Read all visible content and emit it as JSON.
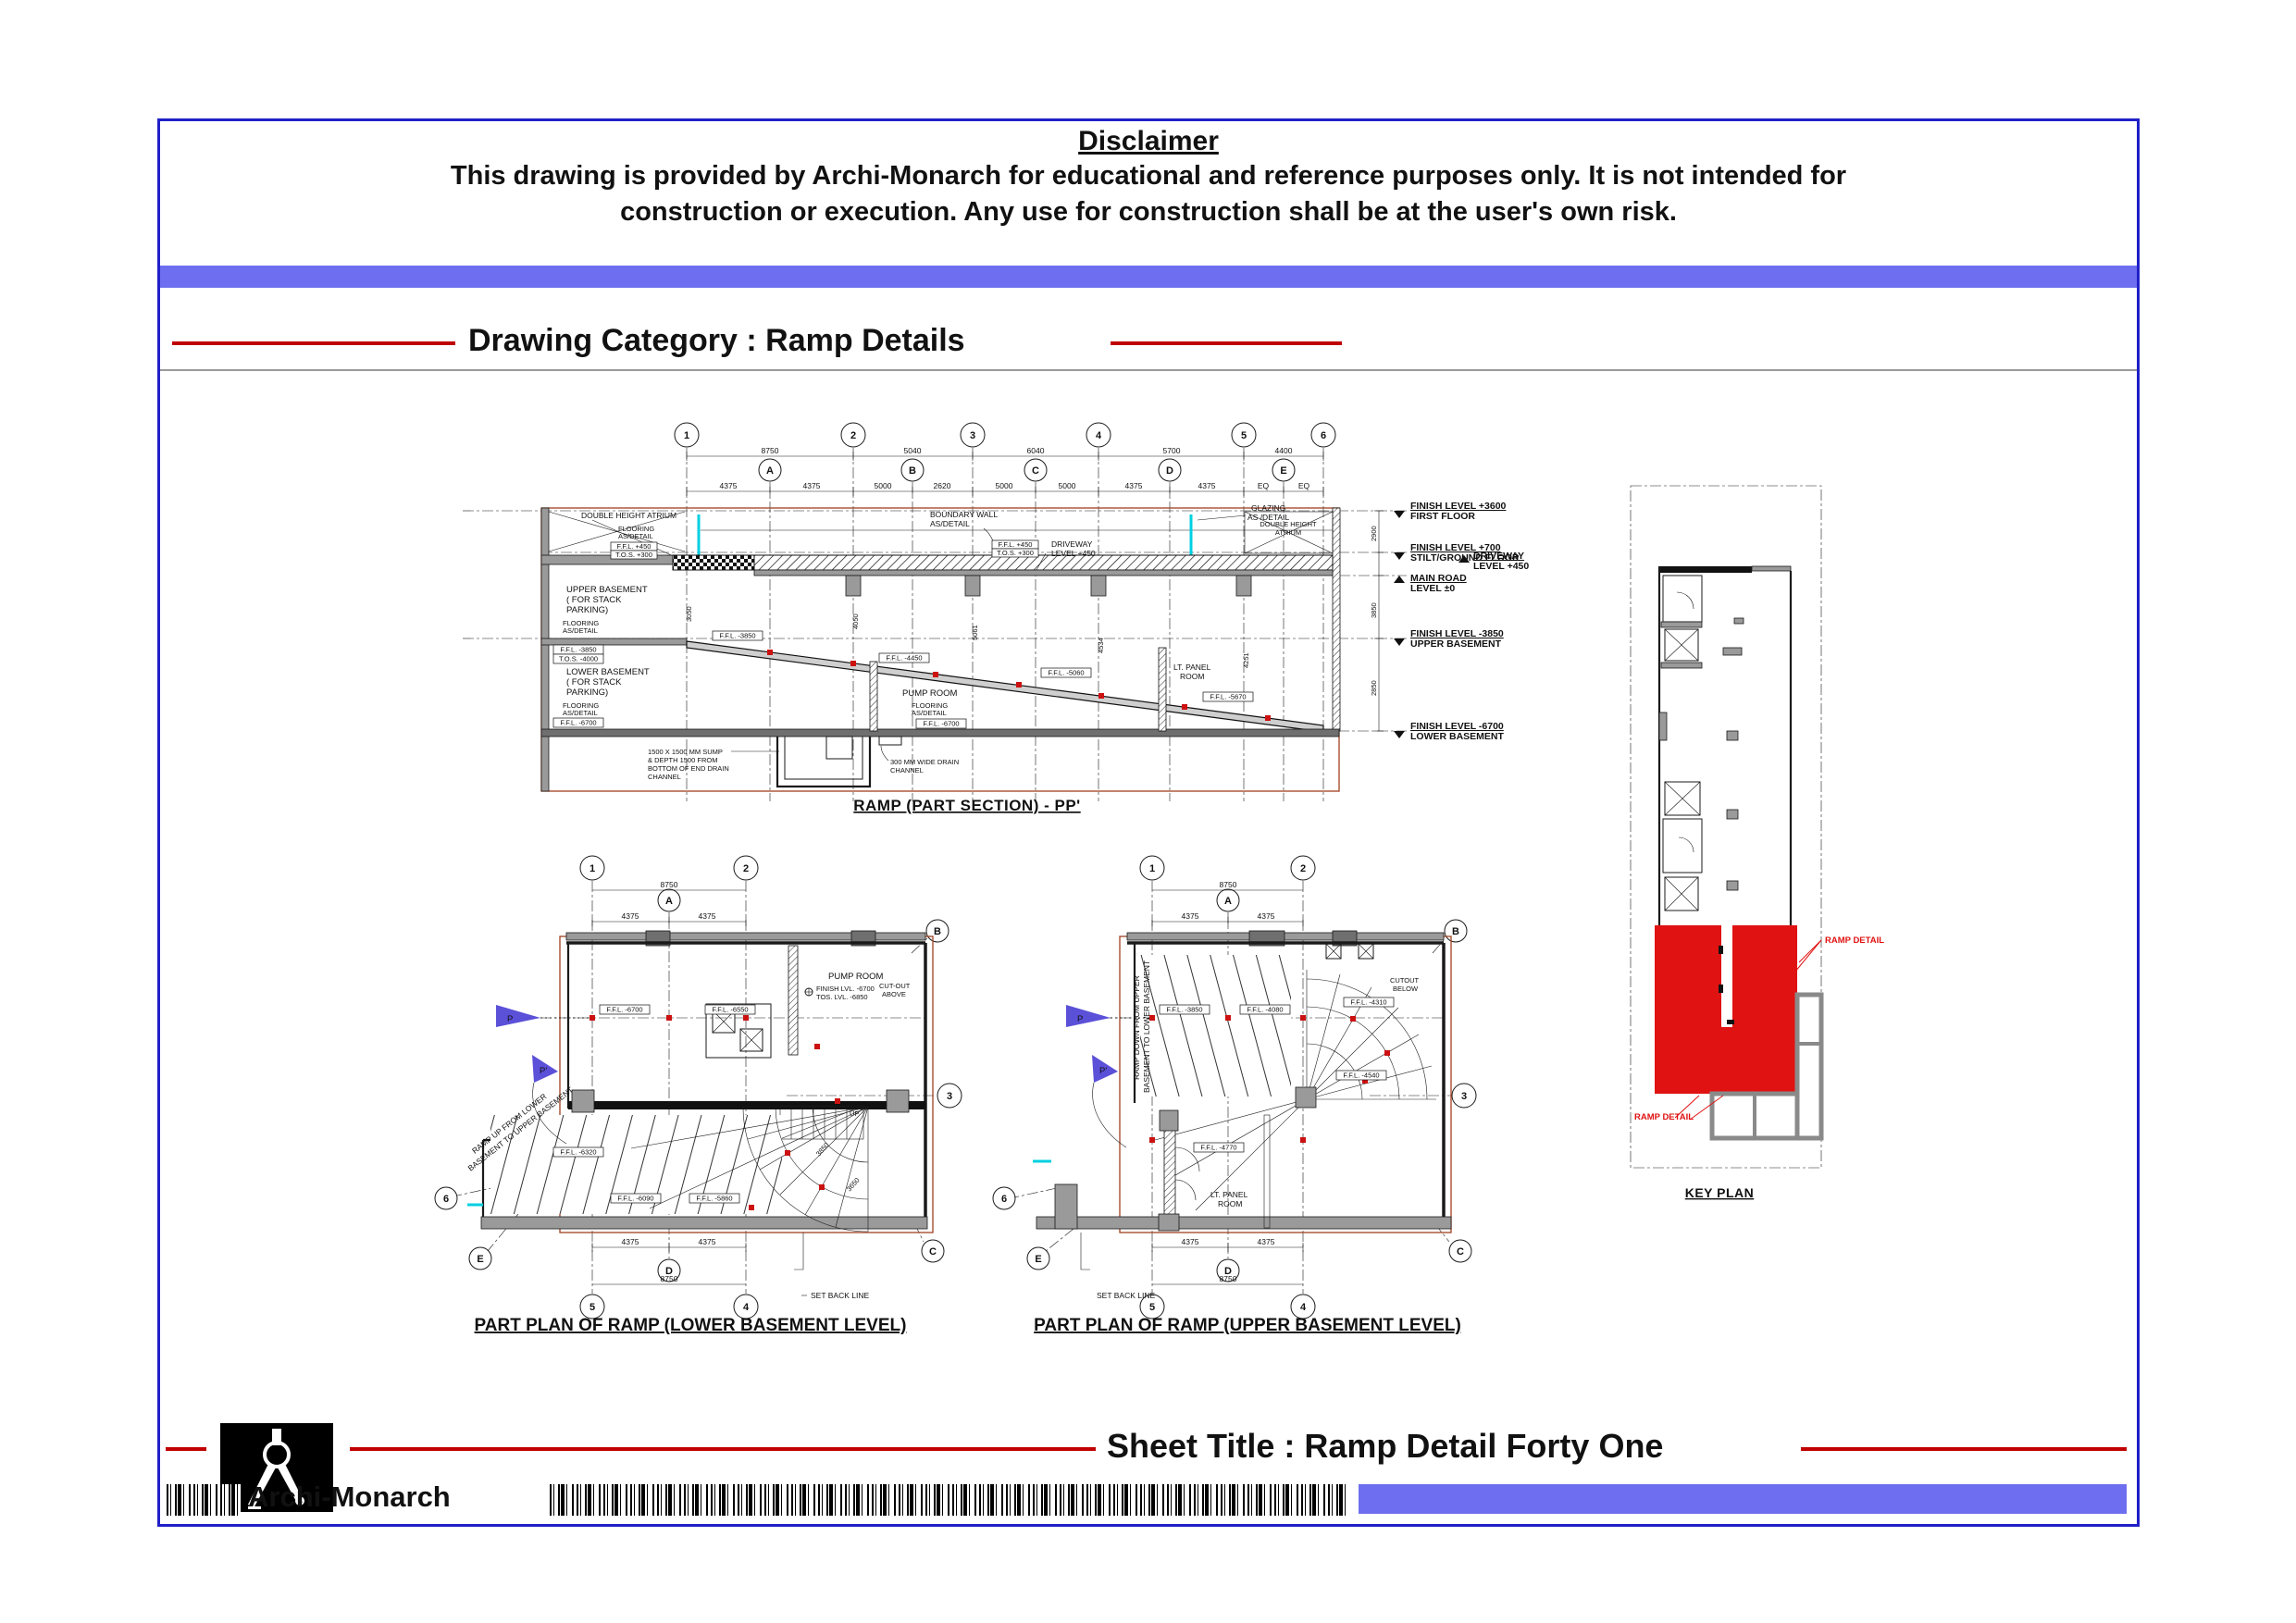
{
  "page": {
    "disclaimer_heading": "Disclaimer",
    "disclaimer_line1": "This drawing is provided by Archi-Monarch for educational and reference purposes only. It is not intended for",
    "disclaimer_line2": "construction or execution. Any use for construction shall be at the user's own risk.",
    "category_heading": "Drawing Category : Ramp Details",
    "sheet_title": "Sheet Title : Ramp Detail Forty One",
    "brand_name": "Archi-Monarch"
  },
  "colors": {
    "accent_blue": "#6e6ef0",
    "border_blue": "#2020c8",
    "line_red": "#c00000",
    "highlight_red": "#e01212",
    "frame_brown": "#a04020",
    "glazing_cyan": "#00d0e0",
    "flag_violet": "#5b50d8"
  },
  "grids": {
    "n1": "1",
    "n2": "2",
    "n3": "3",
    "n4": "4",
    "n5": "5",
    "n6": "6",
    "a": "A",
    "b": "B",
    "c": "C",
    "d": "D",
    "e": "E"
  },
  "section": {
    "title": "RAMP  (PART SECTION) - PP'",
    "dims_row1": [
      "8750",
      "5040",
      "6040",
      "5700",
      "4400"
    ],
    "dims_row2": [
      "4375",
      "4375",
      "5000",
      "2620",
      "5000",
      "5000",
      "4375",
      "4375",
      "EQ",
      "EQ"
    ],
    "vdims": [
      "3050",
      "4050",
      "5061",
      "4534",
      "4251"
    ],
    "vdims_right": [
      "2900",
      "3850",
      "2850"
    ],
    "levels": [
      {
        "value": "FINISH LEVEL +3600",
        "name": "FIRST FLOOR"
      },
      {
        "value": "FINISH LEVEL +700",
        "name": "STILT/GROUND FLOOR"
      },
      {
        "value": "DRIVEWAY",
        "name": "LEVEL +450"
      },
      {
        "value": "MAIN ROAD",
        "name": "LEVEL ±0"
      },
      {
        "value": "FINISH LEVEL -3850",
        "name": "UPPER BASEMENT"
      },
      {
        "value": "FINISH LEVEL -6700",
        "name": "LOWER BASEMENT"
      }
    ],
    "labels": {
      "atrium_left": "DOUBLE HEIGHT ATRIUM",
      "atrium_right_1": "DOUBLE HEIGHT",
      "atrium_right_2": "ATRIUM",
      "boundary_1": "BOUNDARY WALL",
      "boundary_2": "AS/DETAIL",
      "glazing_1": "GLAZING",
      "glazing_2": "AS /DETAIL",
      "driveway_int_1": "DRIVEWAY",
      "driveway_int_2": "LEVEL +450",
      "upper_basement_1": "UPPER BASEMENT",
      "upper_basement_2": "( FOR STACK",
      "upper_basement_3": "PARKING)",
      "lower_basement_1": "LOWER BASEMENT",
      "lower_basement_2": "( FOR STACK",
      "lower_basement_3": "PARKING)",
      "flooring_1": "FLOORING",
      "flooring_2": "AS/DETAIL",
      "pump_room": "PUMP ROOM",
      "lt_panel_1": "LT. PANEL",
      "lt_panel_2": "ROOM",
      "sump_1": "1500 X 1500 MM SUMP",
      "sump_2": "& DEPTH 1500 FROM",
      "sump_3": "BOTTOM OF END DRAIN",
      "sump_4": "CHANNEL",
      "drain_1": "300 MM WIDE DRAIN",
      "drain_2": "CHANNEL",
      "ffl_450": "F.F.L. +450",
      "tos_300": "T.O.S. +300",
      "ffl_3850": "F.F.L. -3850",
      "tos_4000": "T.O.S. -4000",
      "ffl_6700": "F.F.L. -6700",
      "tos_6850": "T.O.S. -6850"
    },
    "ffl_tags": [
      "F.F.L. -3850",
      "F.F.L. -4450",
      "F.F.L. -5060",
      "F.F.L. -5670",
      "F.F.L. -6280",
      "F.F.L. -6700"
    ]
  },
  "plan_lower": {
    "title": "PART PLAN OF RAMP    (LOWER BASEMENT LEVEL)",
    "pump_room": "PUMP ROOM",
    "pump_lvl1": "FINISH LVL. -6700",
    "pump_lvl2": "TOS. LVL. -6850",
    "cutout_1": "CUT-OUT",
    "cutout_2": "ABOVE",
    "ramp_dir_1": "RAMP UP FROM LOWER",
    "ramp_dir_2": "BASEMENT TO UPPER BASEMENT",
    "up_label": "UP",
    "setback": "SET BACK LINE",
    "dim_top": "8750",
    "dim_half_a": "4375",
    "dim_half_b": "4375",
    "dim_bot": "8750",
    "arc_dims": [
      "3850",
      "3650"
    ],
    "ffl_tags": [
      "F.F.L. -6700",
      "F.F.L. -6550",
      "F.F.L. -6320",
      "F.F.L. -6090",
      "F.F.L. -5860"
    ],
    "flag_p": "P",
    "flag_p2": "P'"
  },
  "plan_upper": {
    "title": "PART PLAN OF RAMP    (UPPER BASEMENT LEVEL)",
    "lt_panel_1": "LT. PANEL",
    "lt_panel_2": "ROOM",
    "cutout_1": "CUTOUT",
    "cutout_2": "BELOW",
    "ramp_dir_1": "RAMP DOWN FROM UPPER",
    "ramp_dir_2": "BASEMENT  TO LOWER BASEMENT",
    "setback": "SET BACK LINE",
    "dim_top": "8750",
    "dim_half_a": "4375",
    "dim_half_b": "4375",
    "dim_bot": "8750",
    "ffl_tags": [
      "F.F.L. -3850",
      "F.F.L. -4080",
      "F.F.L. -4310",
      "F.F.L. -4540",
      "F.F.L. -4770"
    ],
    "flag_p": "P",
    "flag_p2": "P'"
  },
  "key_plan": {
    "title": "KEY PLAN",
    "ramp_detail_1": "RAMP DETAIL",
    "ramp_detail_2": "RAMP DETAIL"
  }
}
